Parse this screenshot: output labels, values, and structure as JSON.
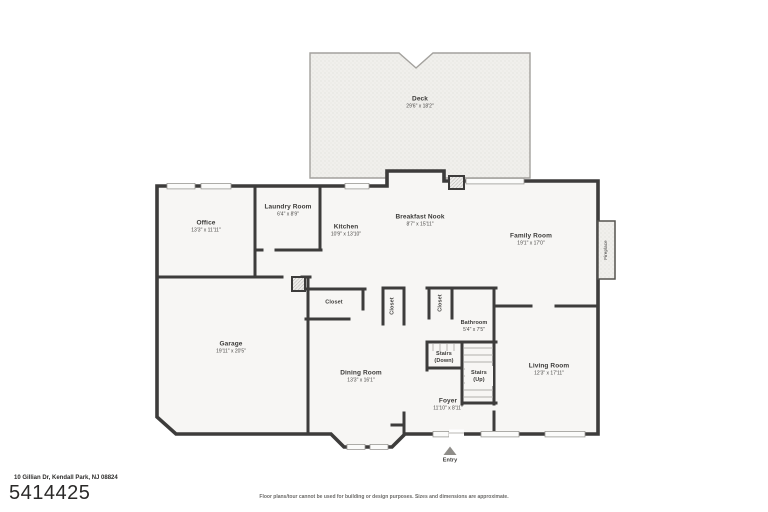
{
  "footer": {
    "address": "10 Gillian Dr, Kendall Park, NJ 08824",
    "listing_id": "5414425",
    "disclaimer": "Floor plans/tour cannot be used for building or design purposes. Sizes and dimensions are approximate."
  },
  "rooms": {
    "deck": {
      "name": "Deck",
      "dims": "29'6\" x 18'2\""
    },
    "office": {
      "name": "Office",
      "dims": "13'3\" x 11'11\""
    },
    "laundry_room": {
      "name": "Laundry Room",
      "dims": "6'4\" x 8'9\""
    },
    "kitchen": {
      "name": "Kitchen",
      "dims": "10'9\" x 13'10\""
    },
    "breakfast_nook": {
      "name": "Breakfast Nook",
      "dims": "8'7\" x 15'11\""
    },
    "family_room": {
      "name": "Family Room",
      "dims": "19'1\" x 17'0\""
    },
    "garage": {
      "name": "Garage",
      "dims": "19'11\" x 20'5\""
    },
    "hall_closet": {
      "name": "Closet"
    },
    "dining_closet": {
      "name": "Closet"
    },
    "bath_closet": {
      "name": "Closet"
    },
    "bathroom": {
      "name": "Bathroom",
      "dims": "5'4\" x 7'5\""
    },
    "stairs_down": {
      "name": "Stairs",
      "dims": "(Down)"
    },
    "stairs_up": {
      "name": "Stairs",
      "dims": "(Up)"
    },
    "living_room": {
      "name": "Living Room",
      "dims": "12'3\" x 17'11\""
    },
    "dining_room": {
      "name": "Dining Room",
      "dims": "13'3\" x 16'1\""
    },
    "foyer": {
      "name": "Foyer",
      "dims": "11'10\" x 8'11\""
    },
    "entry": {
      "name": "Entry"
    },
    "fireplace": {
      "name": "Fireplace"
    }
  },
  "colors": {
    "wall": "#3d3c3b",
    "room_fill": "#f7f6f4",
    "deck_fill": "#f0efec",
    "window_sill": "#fbfbfa"
  }
}
